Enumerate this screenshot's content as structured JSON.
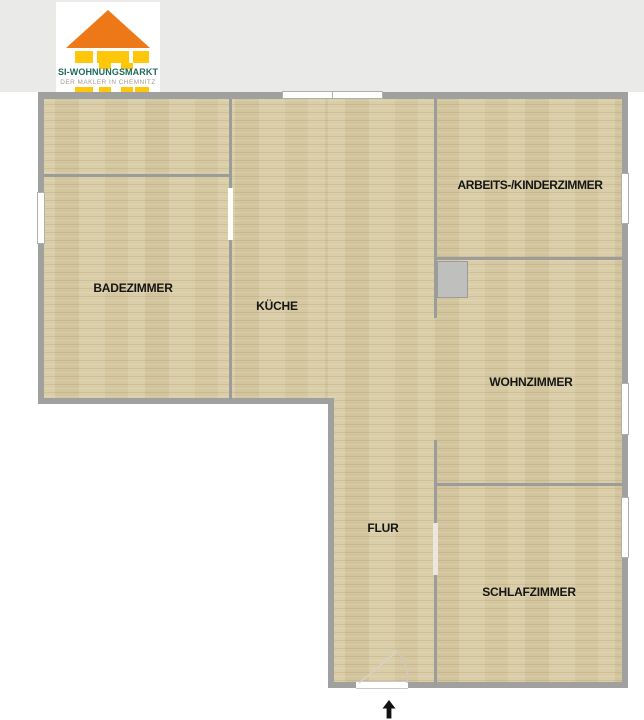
{
  "header": {
    "band_color": "#eaeae8"
  },
  "logo": {
    "title": "SI-WOHNUNGSMARKT",
    "subtitle": "DER MAKLER IN CHEMNITZ",
    "colors": {
      "roof": "#ed7817",
      "body": "#ffc70a",
      "title_text": "#1f6a5c",
      "subtitle_text": "#a39c92"
    }
  },
  "floorplan": {
    "colors": {
      "floor": "#d8cba4",
      "outer_wall": "#a0a09e",
      "inner_wall": "#9c9c9a",
      "window_fill": "#ffffff",
      "shaft_fill": "#bfbfbd",
      "label_text": "#151515"
    },
    "rooms": [
      {
        "id": "arbeits-kinderzimmer",
        "label": "ARBEITS-/KINDERZIMMER"
      },
      {
        "id": "badezimmer",
        "label": "BADEZIMMER"
      },
      {
        "id": "kueche",
        "label": "KÜCHE"
      },
      {
        "id": "wohnzimmer",
        "label": "WOHNZIMMER"
      },
      {
        "id": "flur",
        "label": "FLUR"
      },
      {
        "id": "schlafzimmer",
        "label": "SCHLAFZIMMER"
      }
    ],
    "features": {
      "windows_count": 5,
      "shaft": "utility-shaft",
      "entrance": "bottom-entrance-door"
    },
    "icons": {
      "entrance_arrow_icon": "↑"
    }
  }
}
